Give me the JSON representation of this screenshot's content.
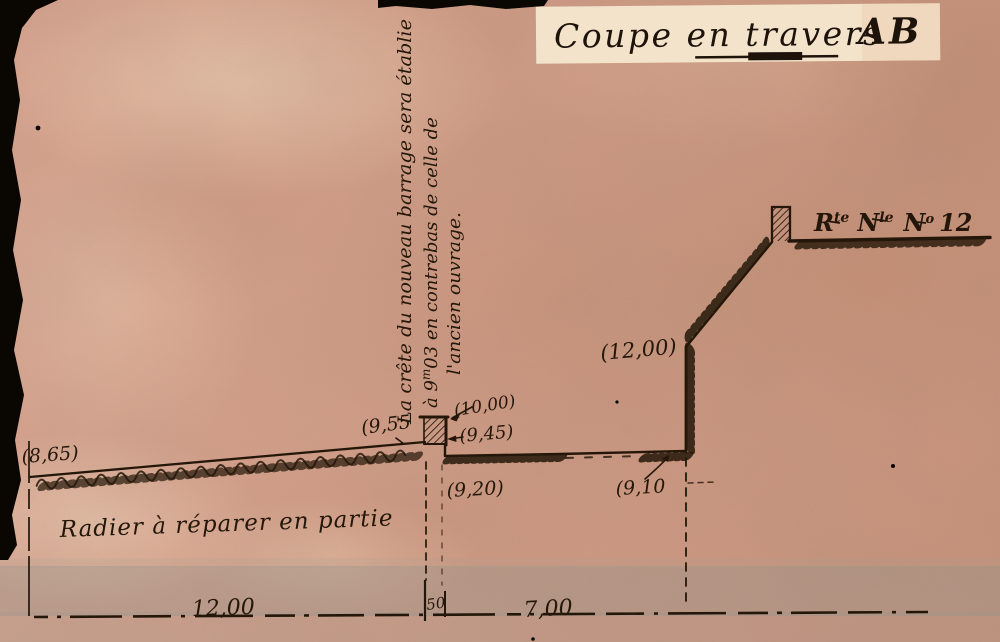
{
  "title": {
    "main": "Coupe en travers",
    "section": "AB"
  },
  "handwritten_note": {
    "line1": "La crête du nouveau barrage sera établie",
    "line2_a": "à 9",
    "line2_sup": "m",
    "line2_b": "03 en contrebas de celle de",
    "line3": "l'ancien ouvrage."
  },
  "elevations": {
    "upstream_ground": "(8,65)",
    "old_crest": "(9,55",
    "new_crest": "(10,00)",
    "crest_ledge": "(9,45)",
    "floor_upstream": "(9,20)",
    "floor_downstream": "(9,10",
    "wall_top": "(12,00)"
  },
  "annotations": {
    "radier": "Radier à réparer en partie"
  },
  "road_sign": {
    "r": "R",
    "r_sup": "te",
    "n": "N",
    "n_sup": "le",
    "no": "N",
    "no_sup": "o",
    "number": "12"
  },
  "dimensions": {
    "radier_length": "12,00",
    "wall_width": "50",
    "basin_width": "7,00"
  },
  "colors": {
    "paper": "#d8a38e",
    "ink": "#241709",
    "label_paper": "#f3e3cb",
    "scan_edge": "#0a0703",
    "shadow_band": "#8e938c"
  }
}
